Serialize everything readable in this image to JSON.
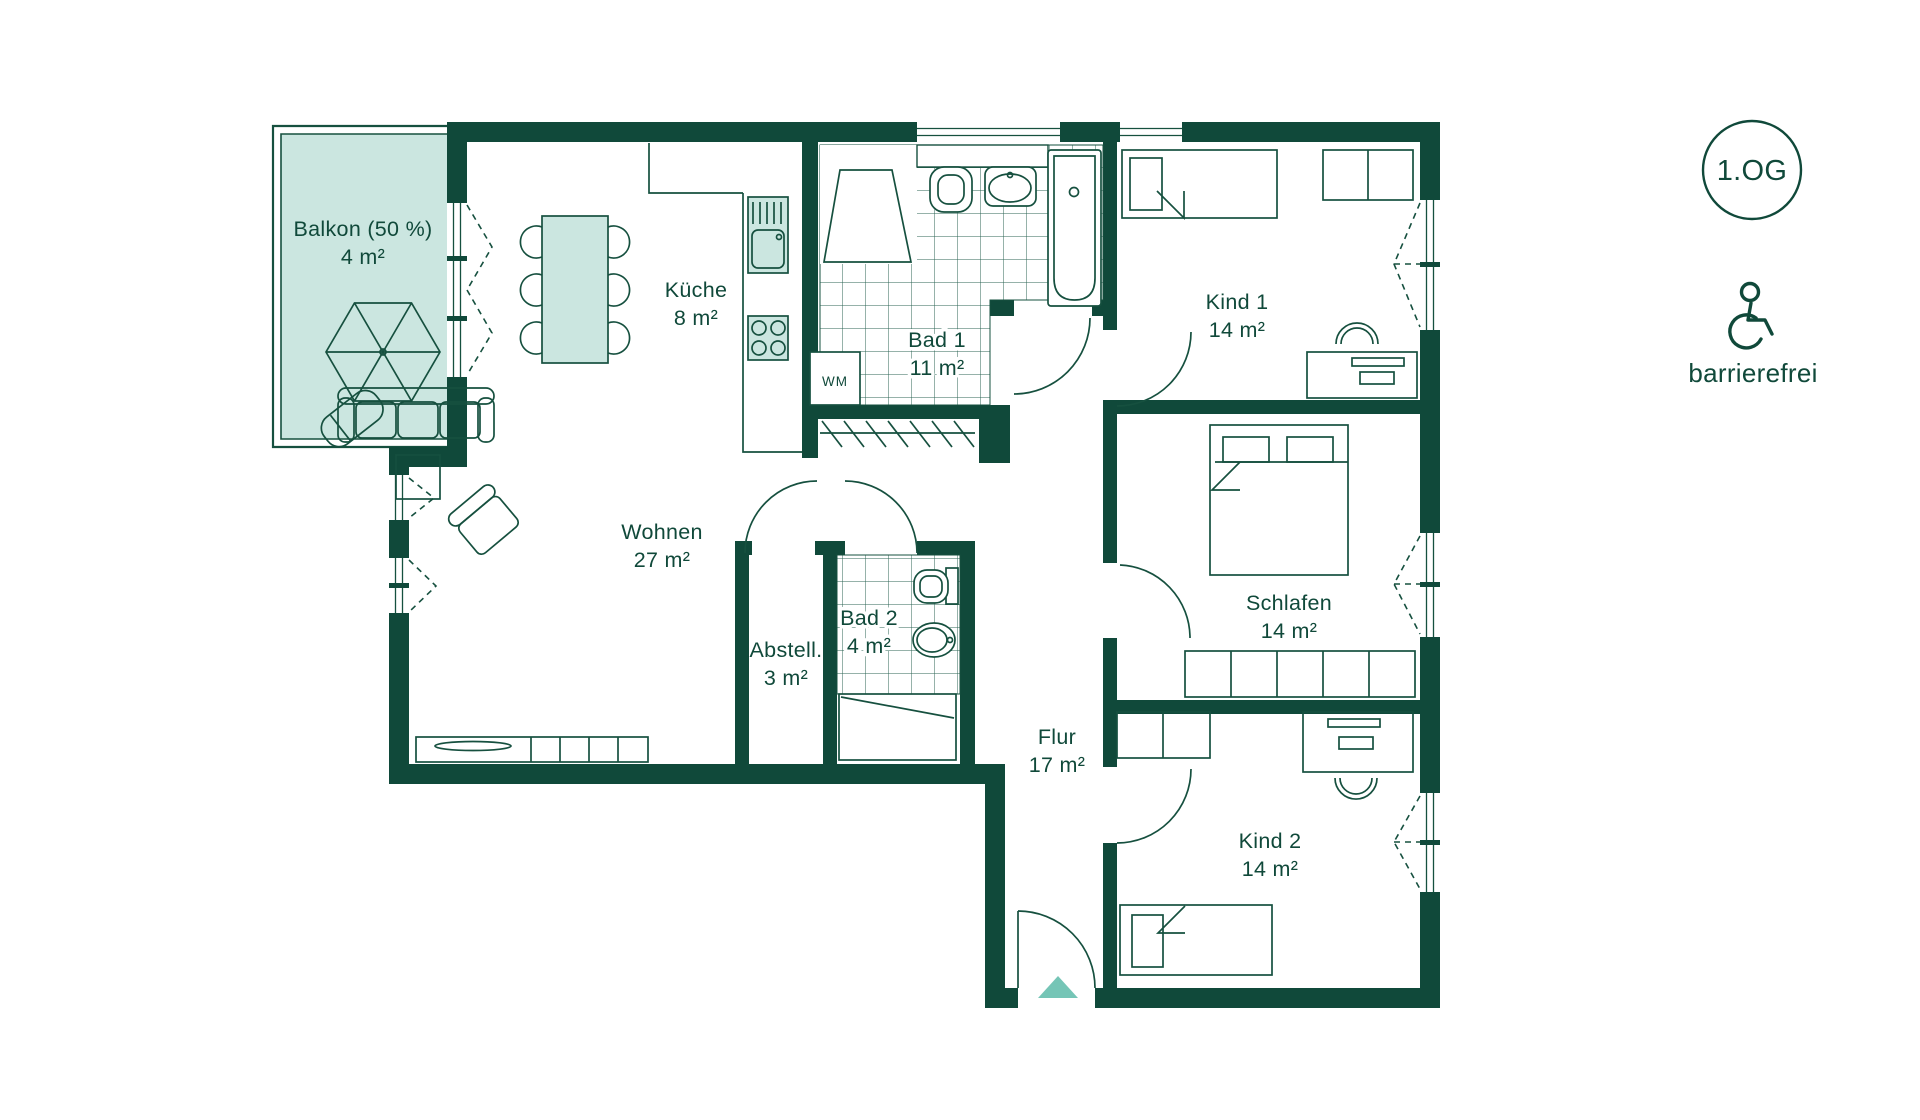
{
  "plan": {
    "title": "Wohnungsgrundriss",
    "floor_badge": "1.OG",
    "accessibility_label": "barrierefrei",
    "accessibility_icon": "wheelchair-icon"
  },
  "colors": {
    "wall": "#10493a",
    "floor": "#cbe6e0",
    "accent_arrow": "#75c5b6",
    "fixture_fill": "#ffffff",
    "text": "#10493a"
  },
  "rooms": [
    {
      "id": "balkon",
      "name": "Balkon (50 %)",
      "area": "4 m²"
    },
    {
      "id": "wohnen",
      "name": "Wohnen",
      "area": "27 m²"
    },
    {
      "id": "kueche",
      "name": "Küche",
      "area": "8 m²"
    },
    {
      "id": "bad1",
      "name": "Bad 1",
      "area": "11 m²"
    },
    {
      "id": "kind1",
      "name": "Kind 1",
      "area": "14 m²"
    },
    {
      "id": "schlafen",
      "name": "Schlafen",
      "area": "14 m²"
    },
    {
      "id": "kind2",
      "name": "Kind 2",
      "area": "14 m²"
    },
    {
      "id": "flur",
      "name": "Flur",
      "area": "17 m²"
    },
    {
      "id": "abstell",
      "name": "Abstell.",
      "area": "3 m²"
    },
    {
      "id": "bad2",
      "name": "Bad 2",
      "area": "4 m²"
    }
  ],
  "appliances": {
    "washing_machine": "WM"
  }
}
